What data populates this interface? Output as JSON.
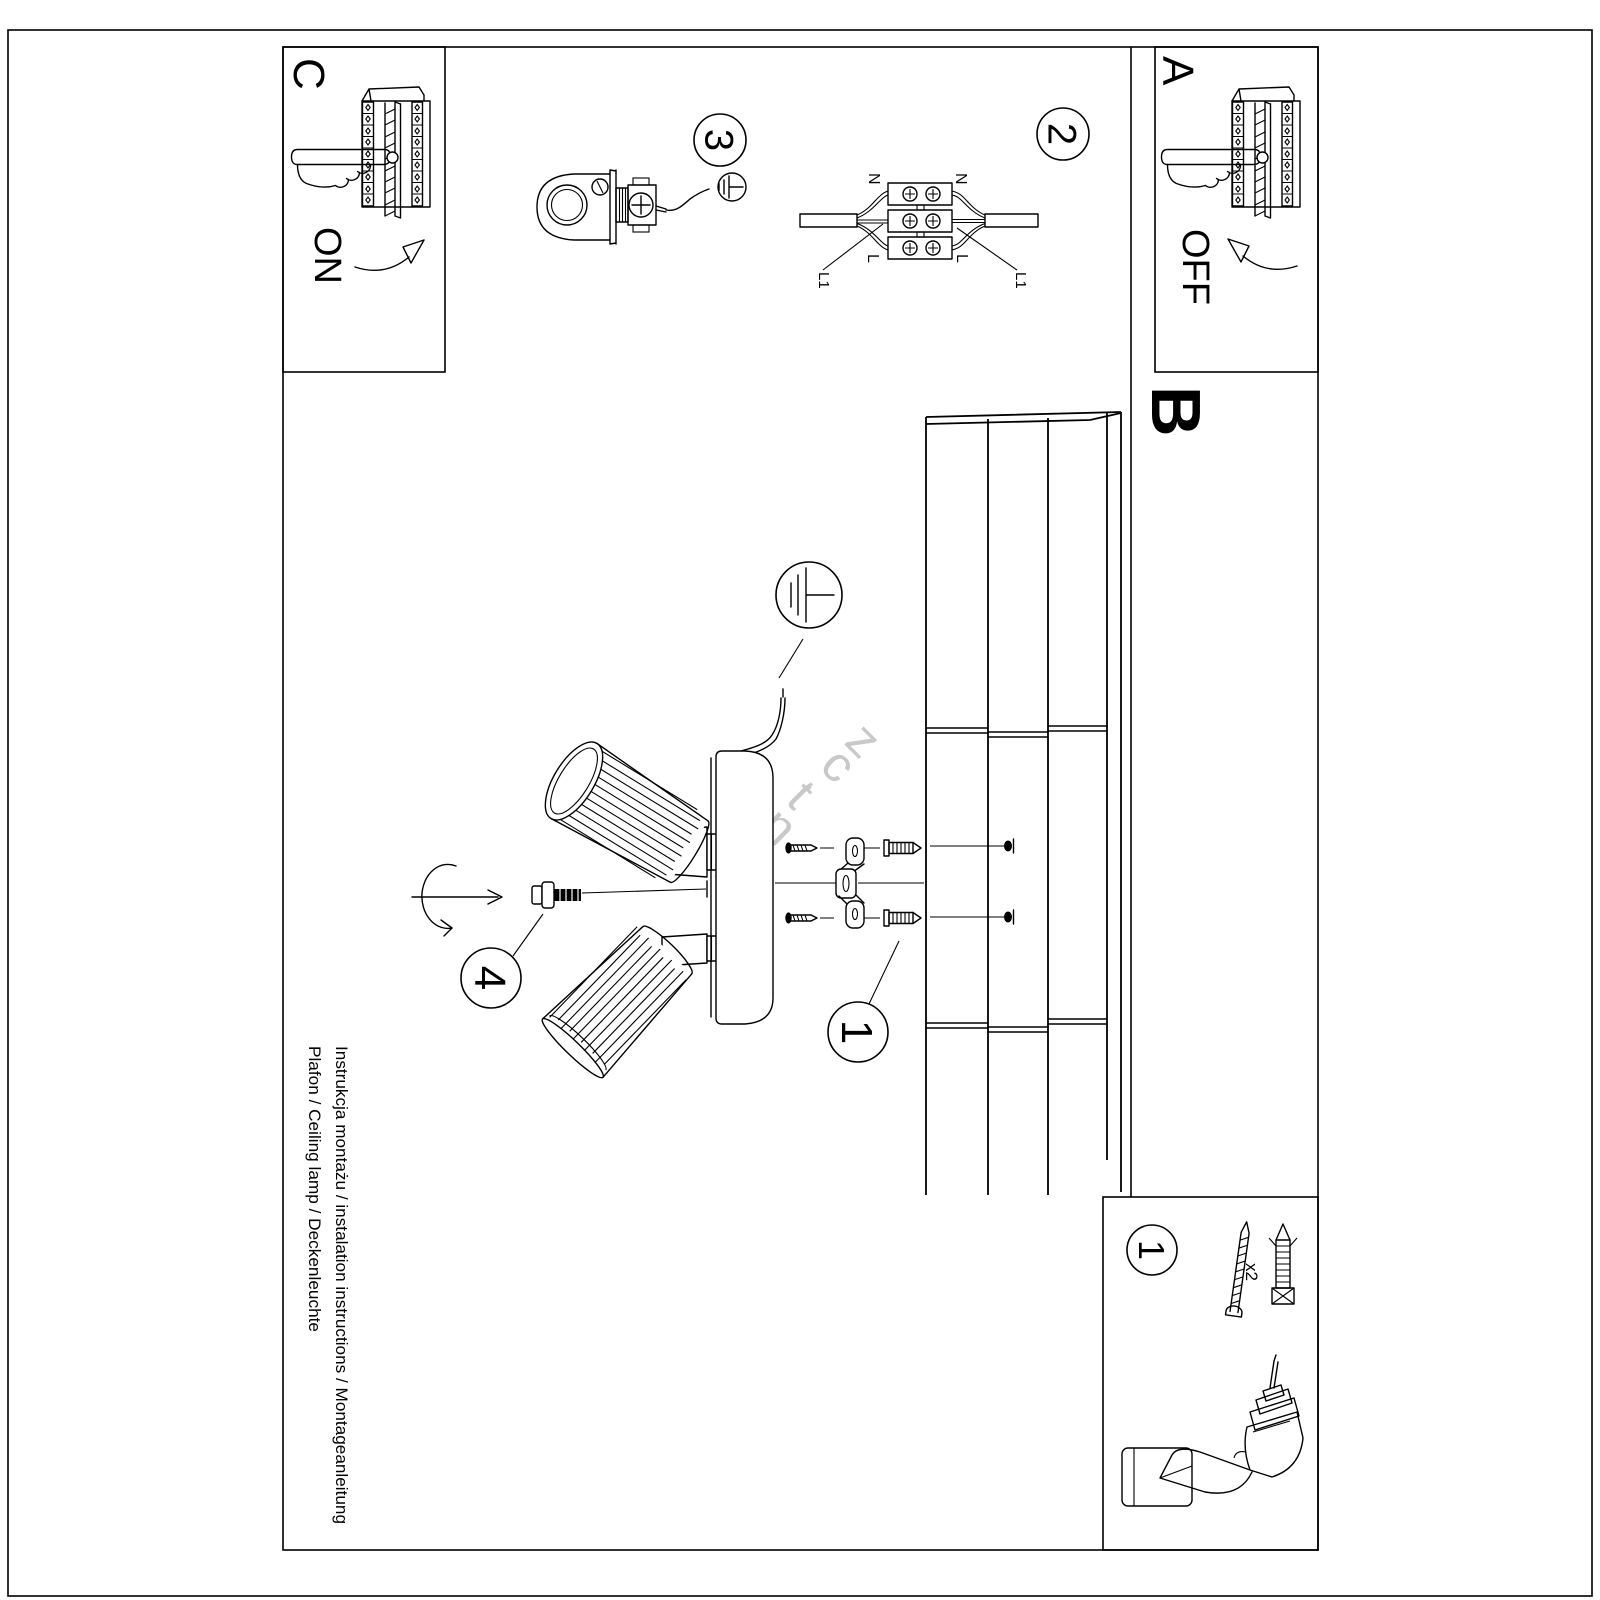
{
  "colors": {
    "ink": "#000000",
    "paper": "#ffffff",
    "watermark": "#c9c9c9"
  },
  "watermark": {
    "text": "rent.cz"
  },
  "sections": {
    "c": {
      "letter": "C",
      "action": "ON"
    },
    "a": {
      "letter": "A",
      "action": "OFF"
    },
    "b": {
      "letter": "B"
    }
  },
  "badges": {
    "mount": "1",
    "wiring": "2",
    "hook": "3",
    "shade": "4",
    "tools": "1"
  },
  "wiring_labels": {
    "n_left": "N",
    "n_right": "N",
    "l_left": "L",
    "l_right": "L",
    "l1_left": "L1",
    "l1_right": "L1"
  },
  "tools": {
    "quantity": "x2"
  },
  "footer": {
    "line1": "Instrukcja montażu / instalation instructions / Montageanleitung",
    "line2": "Plafon / Ceiling lamp / Deckenleuchte"
  }
}
